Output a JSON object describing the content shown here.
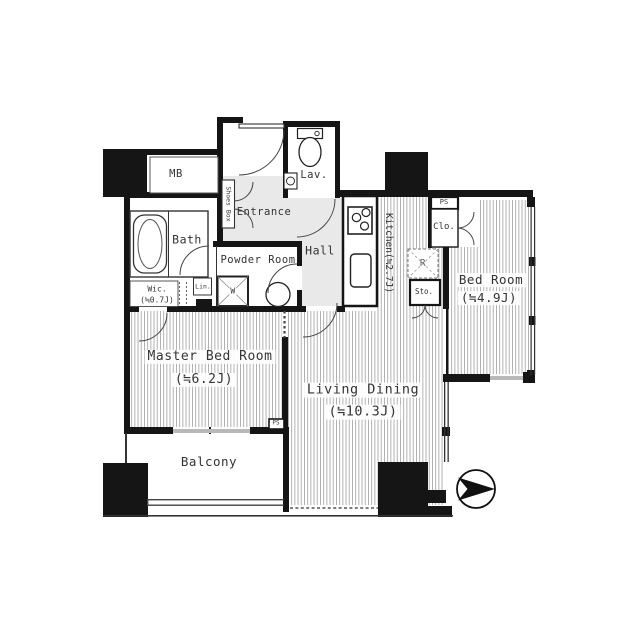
{
  "plan": {
    "type": "apartment-floor-plan",
    "labels": {
      "mb": "MB",
      "shoes_box": "Shoes Box",
      "entrance": "Entrance",
      "lav": "Lav.",
      "bath": "Bath",
      "powder_room": "Powder Room",
      "hall": "Hall",
      "kitchen": "Kitchen(≒2.7J)",
      "ps_top": "PS",
      "clo": "Clo.",
      "refrigerator": "R",
      "sto": "Sto.",
      "bed_room": "Bed Room",
      "bed_room_size": "(≒4.9J)",
      "wic": "Wic.",
      "wic_size": "(≒0.7J)",
      "lin": "Lin.",
      "washer": "W",
      "master_bed_room": "Master Bed Room",
      "master_bed_room_size": "(≒6.2J)",
      "living_dining": "Living Dining",
      "living_dining_size": "(≒10.3J)",
      "balcony": "Balcony",
      "ps_bottom": "PS"
    },
    "icons": {
      "north_arrow": "compass-arrow-pointing-right",
      "toilet": "toilet-icon",
      "bathtub": "bathtub-icon",
      "stove": "3-burner-stove-icon",
      "washing_machine": "washing-machine-pan-icon",
      "sink_round": "round-basin-icon"
    },
    "colors": {
      "wall": "#151515",
      "corridor_fill": "#e9e9e9",
      "floor_hatch": "#ababab",
      "window_gray": "#b8b8b8",
      "text": "#333333",
      "background": "#ffffff"
    }
  }
}
